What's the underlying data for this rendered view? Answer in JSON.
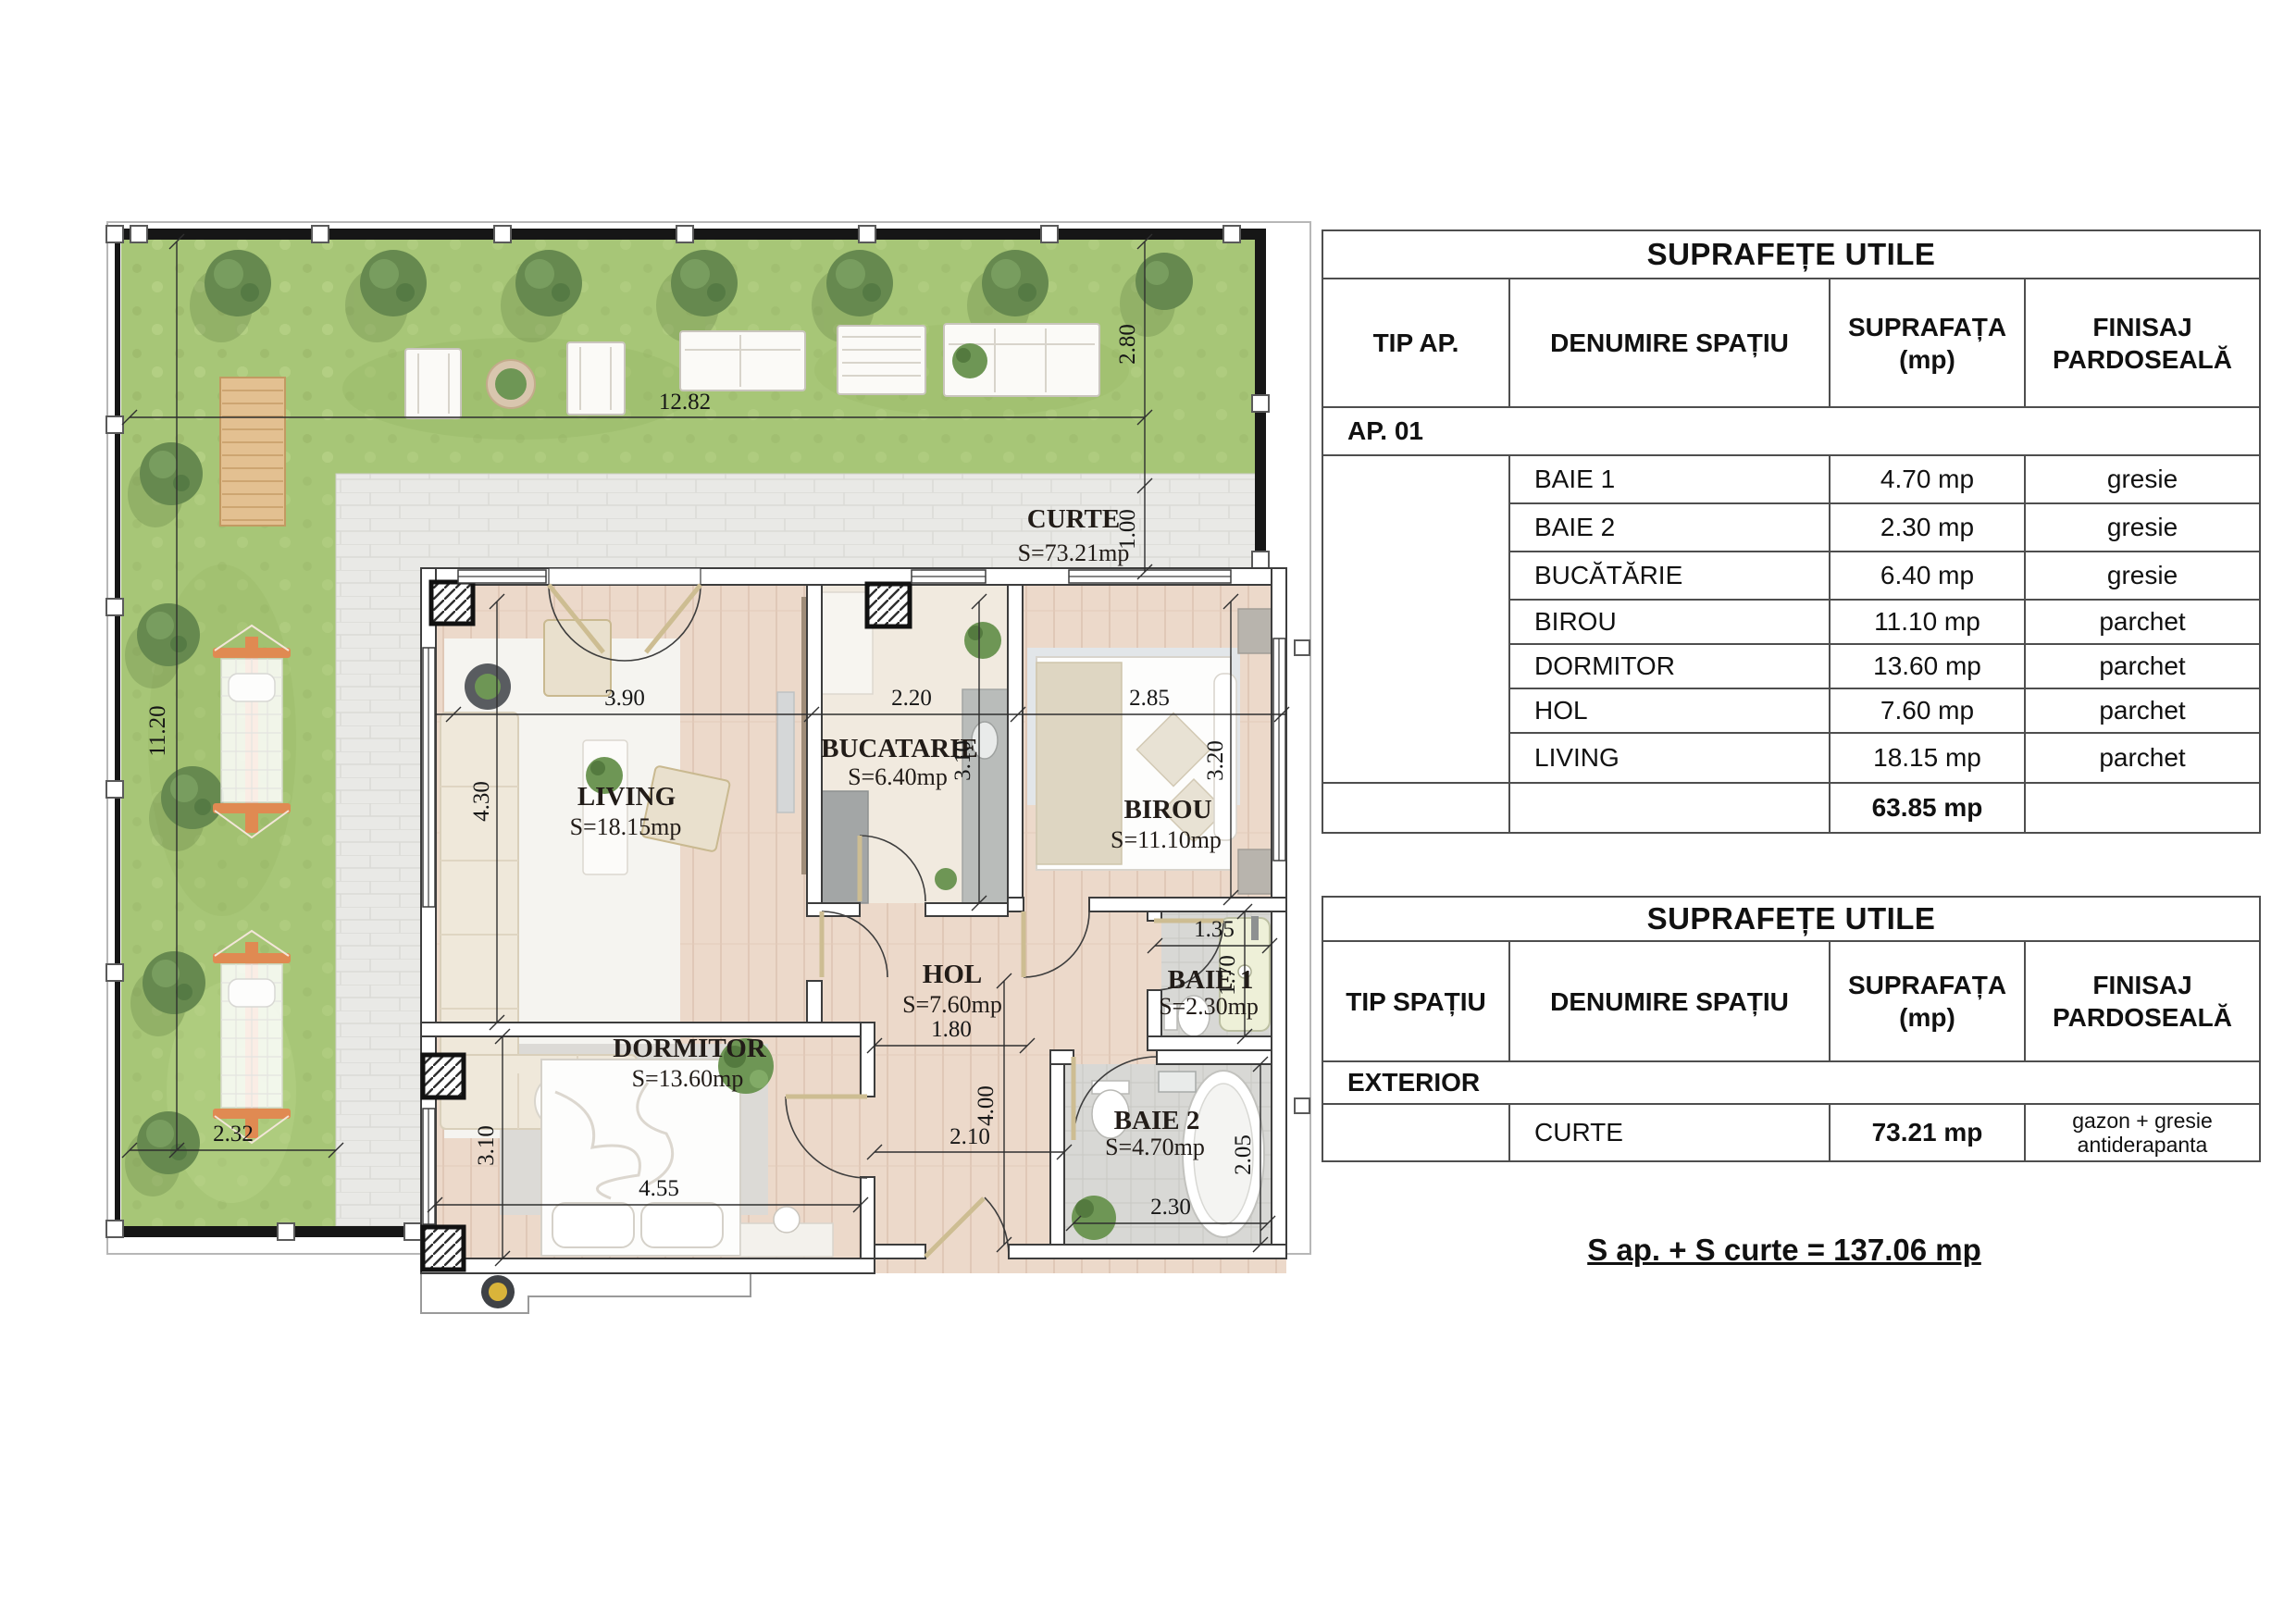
{
  "plan": {
    "curte": {
      "name": "CURTE",
      "area": "S=73.21mp"
    },
    "living": {
      "name": "LIVING",
      "area": "S=18.15mp"
    },
    "bucatarie": {
      "name": "BUCATARIE",
      "area": "S=6.40mp"
    },
    "birou": {
      "name": "BIROU",
      "area": "S=11.10mp"
    },
    "hol": {
      "name": "HOL",
      "area": "S=7.60mp"
    },
    "baie1": {
      "name": "BAIE 1",
      "area": "S=2.30mp"
    },
    "baie2": {
      "name": "BAIE 2",
      "area": "S=4.70mp"
    },
    "dormitor": {
      "name": "DORMITOR",
      "area": "S=13.60mp"
    },
    "dims": {
      "garden_w": "12.82",
      "garden_h": "11.20",
      "garden_b": "2.32",
      "garden_r": "2.80",
      "walkway": "1.00",
      "living_w": "3.90",
      "living_h": "4.30",
      "bucatarie_w": "2.20",
      "bucatarie_h": "3.10",
      "birou_w": "2.85",
      "birou_h": "3.20",
      "hol_top": "1.80",
      "hol_h": "4.00",
      "hol_w": "2.10",
      "baie1_w": "1.35",
      "baie1_h": "1.70",
      "baie2_w": "2.30",
      "baie2_h": "2.05",
      "dormitor_w": "4.55",
      "dormitor_h": "3.10"
    }
  },
  "table1": {
    "title": "SUPRAFEȚE UTILE",
    "col1": "TIP AP.",
    "col2": "DENUMIRE SPAȚIU",
    "col3": "SUPRAFAȚA (mp)",
    "col4": "FINISAJ PARDOSEALĂ",
    "group": "AP. 01",
    "rows": [
      {
        "name": "BAIE 1",
        "area": "4.70 mp",
        "finish": "gresie"
      },
      {
        "name": "BAIE 2",
        "area": "2.30 mp",
        "finish": "gresie"
      },
      {
        "name": "BUCĂTĂRIE",
        "area": "6.40 mp",
        "finish": "gresie"
      },
      {
        "name": "BIROU",
        "area": "11.10 mp",
        "finish": "parchet"
      },
      {
        "name": "DORMITOR",
        "area": "13.60 mp",
        "finish": "parchet"
      },
      {
        "name": "HOL",
        "area": "7.60 mp",
        "finish": "parchet"
      },
      {
        "name": "LIVING",
        "area": "18.15 mp",
        "finish": "parchet"
      }
    ],
    "total": "63.85 mp"
  },
  "table2": {
    "title": "SUPRAFEȚE UTILE",
    "col1": "TIP SPAȚIU",
    "col2": "DENUMIRE SPAȚIU",
    "col3": "SUPRAFAȚA (mp)",
    "col4": "FINISAJ PARDOSEALĂ",
    "group": "EXTERIOR",
    "rows": [
      {
        "name": "CURTE",
        "area": "73.21 mp",
        "finish": "gazon + gresie antiderapanta"
      }
    ]
  },
  "summary": "S ap. + S curte = 137.06 mp"
}
